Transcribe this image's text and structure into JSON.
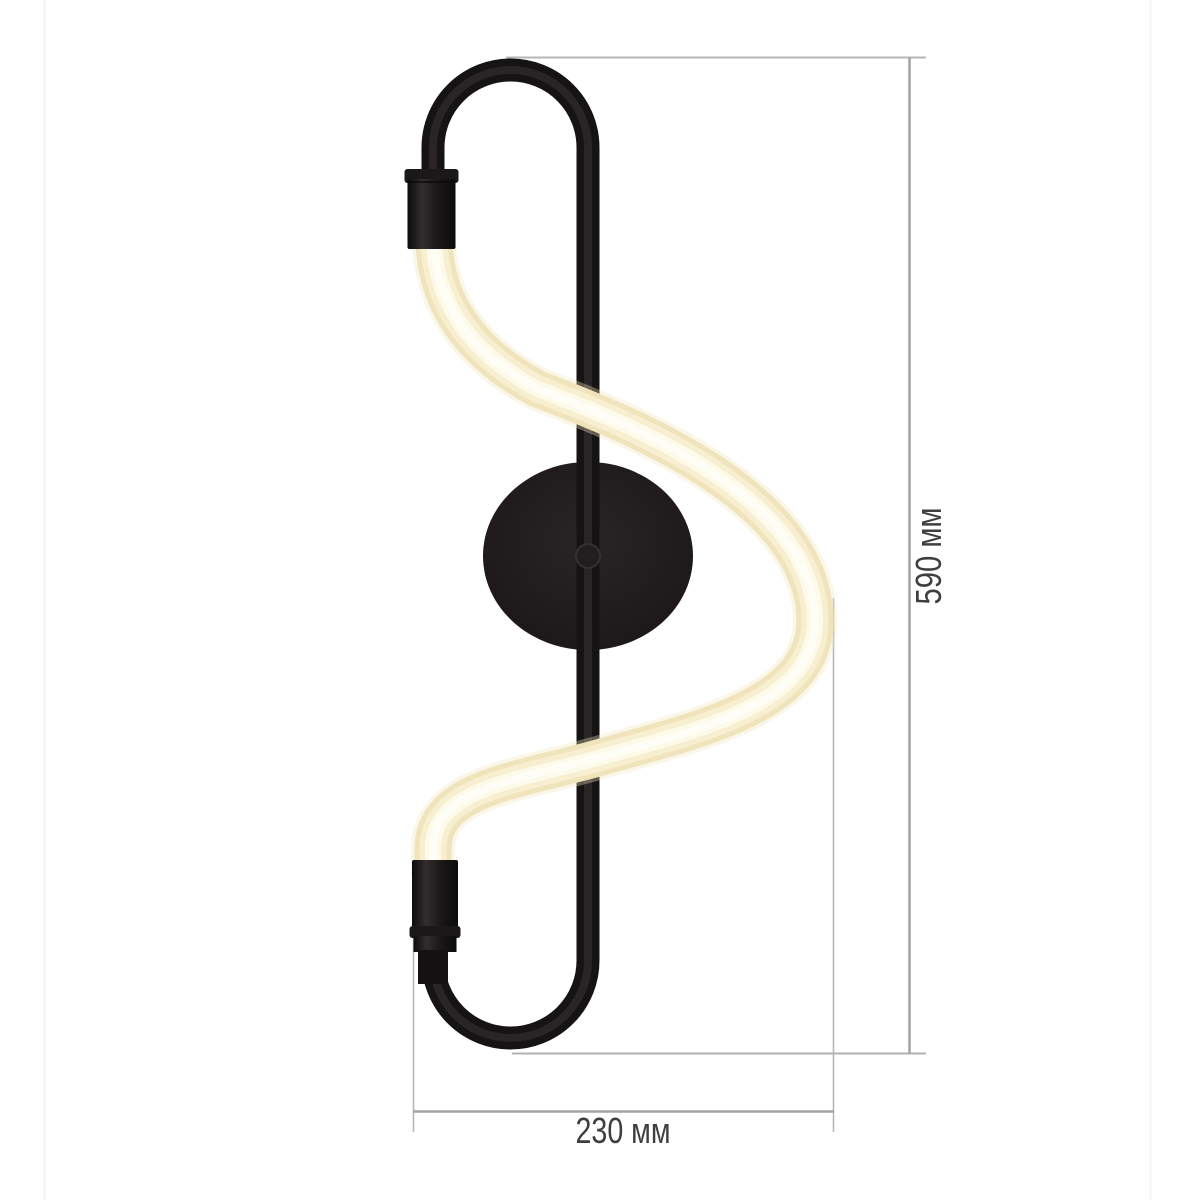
{
  "image": {
    "alt": "Black curved wall lamp with S-shaped LED tube shown with dimension lines",
    "kind": "product dimension diagram"
  },
  "dimensions": {
    "height": {
      "label": "590 мм",
      "value_mm": 590,
      "unit": "мм"
    },
    "width": {
      "label": "230 мм",
      "value_mm": 230,
      "unit": "мм"
    }
  },
  "colors": {
    "background": "#ffffff",
    "frame_black": "#1a1617",
    "cap_black": "#141112",
    "wall_plate": "#201c1d",
    "tube_edge": "#f0e4bc",
    "tube_mid": "#f7efd0",
    "tube_core": "#fffef6",
    "dimension_line": "#a3a3a3",
    "extension_line": "#b7b7b7",
    "label_text": "#3e3e3e",
    "photo_edge": "#f3f3f3"
  }
}
